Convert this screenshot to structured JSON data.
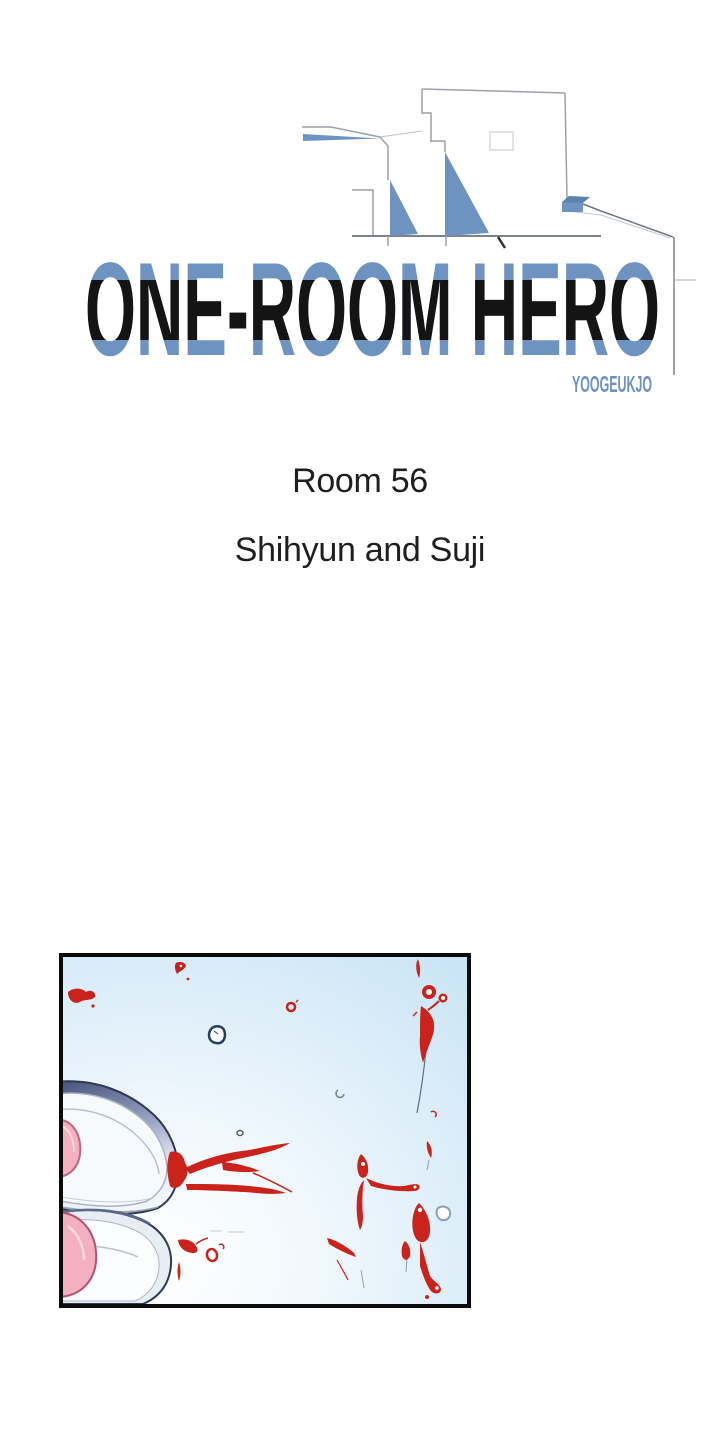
{
  "page": {
    "background": "#ffffff"
  },
  "header": {
    "title": "ONE-ROOM HERO",
    "author": "YOOGEUKJO"
  },
  "chapter": {
    "room_label": "Room 56",
    "subtitle": "Shihyun and Suji"
  },
  "colors": {
    "title_blue": "#6e93c1",
    "title_blue_dark": "#5d82b0",
    "title_black": "#141414",
    "body_text": "#1f1f1f",
    "line_gray": "#9aa1a9",
    "panel_border": "#0b0b0b",
    "sky_blue": "#c7e3f5",
    "blood_red": "#c9231b",
    "heel_pink": "#f3b0bf",
    "slipper_rim_dark": "#46537a",
    "droplet_outline_navy": "#24405e"
  }
}
